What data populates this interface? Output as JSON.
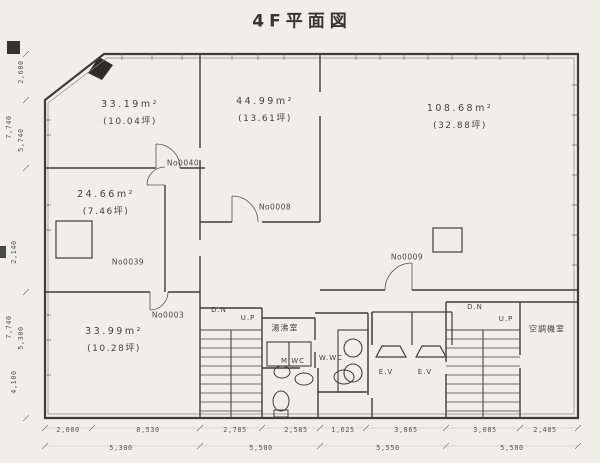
{
  "title": "4F平面図",
  "rooms": [
    {
      "area": "33.19m²",
      "tsubo": "(10.04坪)",
      "no": "No0040"
    },
    {
      "area": "44.99m²",
      "tsubo": "(13.61坪)",
      "no": "No0008"
    },
    {
      "area": "108.68m²",
      "tsubo": "(32.88坪)",
      "no": "No0009"
    },
    {
      "area": "24.66m²",
      "tsubo": "(7.46坪)",
      "no": "No0039"
    },
    {
      "area": "33.99m²",
      "tsubo": "(10.28坪)",
      "no": "No0003"
    }
  ],
  "facilities": {
    "kitchenette": "湯沸室",
    "mens_wc": "M.WC",
    "womens_wc": "W.WC",
    "elevator1": "E.V",
    "elevator2": "E.V",
    "ac_room": "空調機室",
    "stair_left_down": "D.N",
    "stair_left_up": "U.P",
    "stair_right_down": "D.N",
    "stair_right_up": "U.P"
  },
  "dimensions": {
    "bottom_row1": [
      "2,000",
      "8,530",
      "2,785",
      "2,585",
      "1,625",
      "3,865",
      "3,085",
      "2,485"
    ],
    "bottom_row2": [
      "5,300",
      "5,500",
      "5,550",
      "5,500"
    ],
    "left_column": [
      "2,600",
      "7,740",
      "5,740",
      "2,140",
      "7,740",
      "5,300",
      "4,100"
    ]
  },
  "colors": {
    "ink": "#3f3d38",
    "paper": "#efeee9"
  }
}
